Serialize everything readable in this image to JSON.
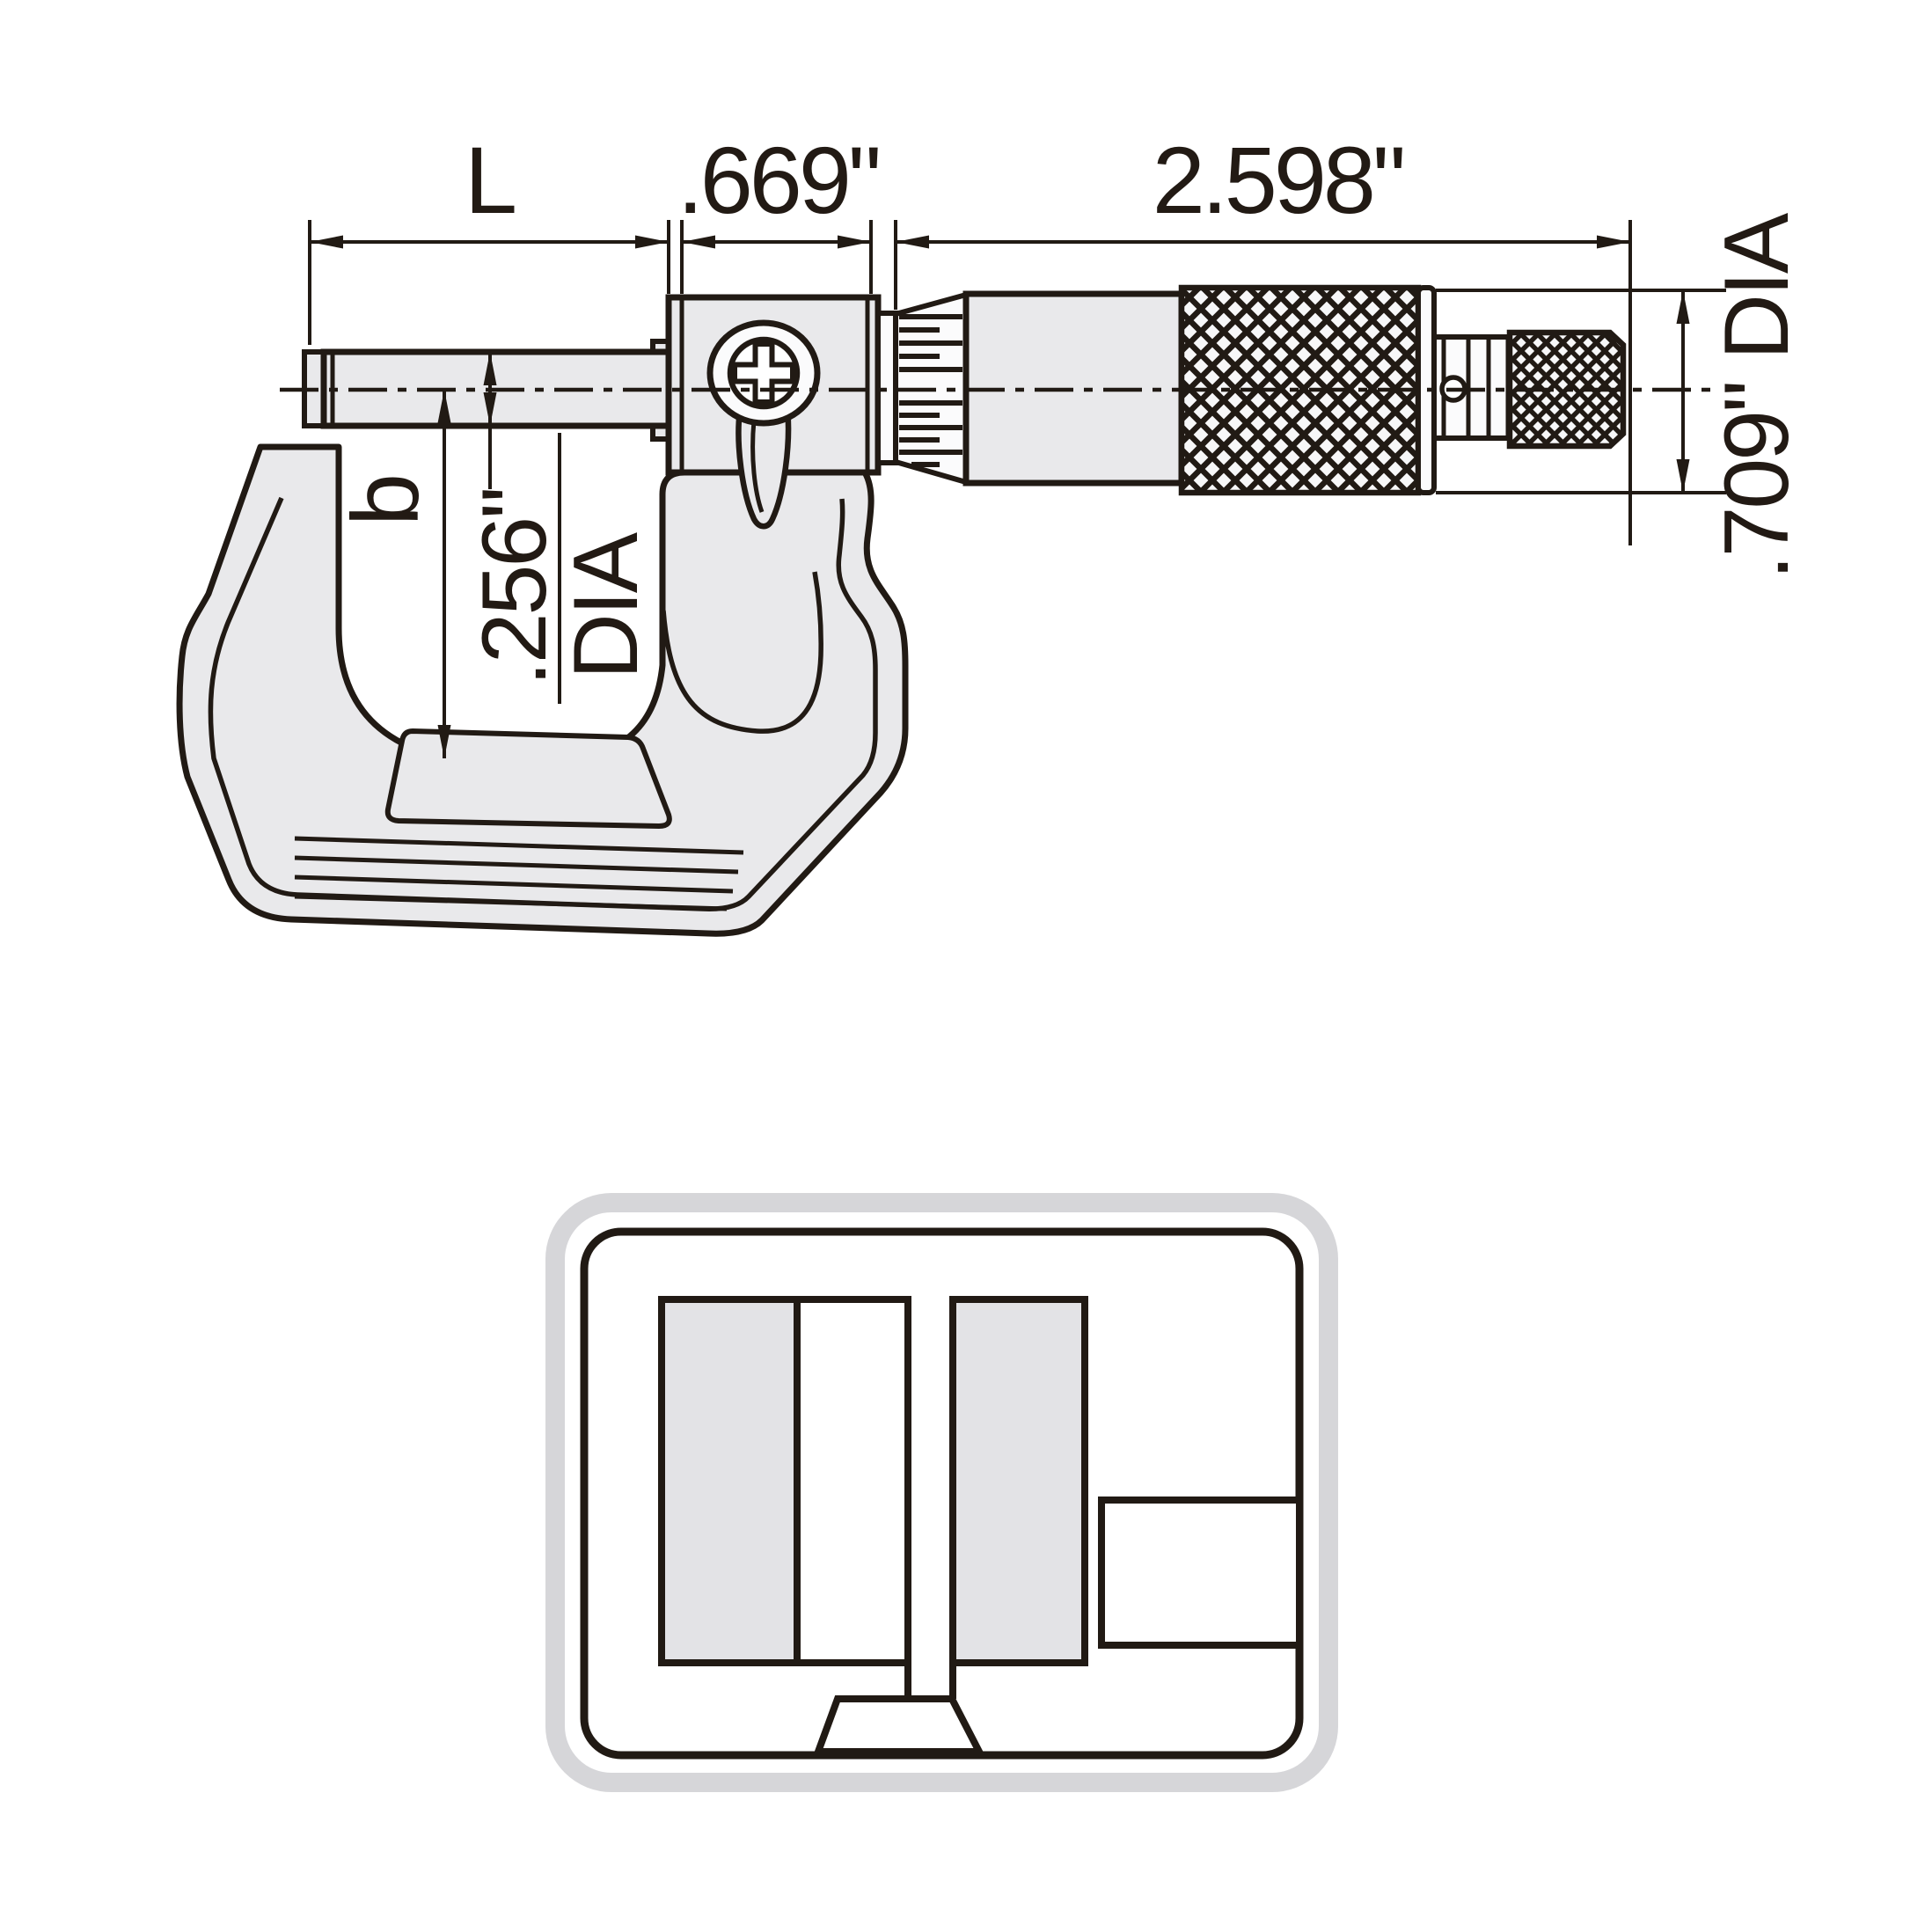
{
  "drawing": {
    "name": "outside micrometer side view technical drawing",
    "labels": {
      "l": "L",
      "head_length": ".669\"",
      "sleeve_length": "2.598\"",
      "thimble_dia": ".709\" DIA",
      "b": "b",
      "spindle_dia_value": ".256\"",
      "spindle_dia_suffix": "DIA"
    },
    "colors": {
      "line": "#211a14",
      "body_fill": "#e9e9eb",
      "inset_block_fill": "#e3e3e6",
      "inset_outer_border": "#d6d6d9",
      "background": "#ffffff"
    }
  }
}
